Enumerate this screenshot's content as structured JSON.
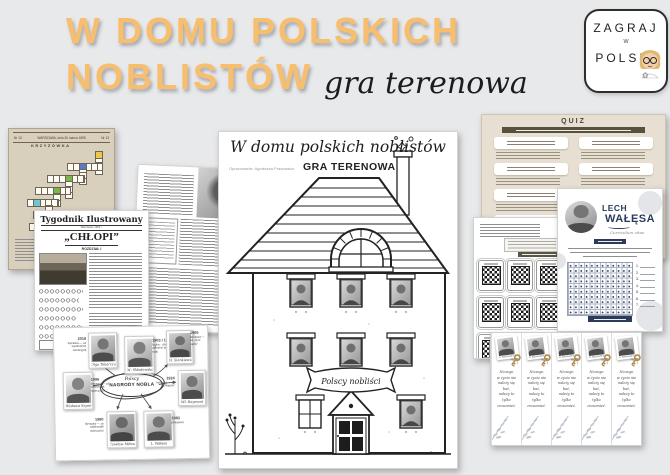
{
  "poster": {
    "title_line1": "W DOMU POLSKICH",
    "title_line2": "NOBLISTÓW",
    "subtitle": "gra terenowa"
  },
  "logo": {
    "word_top": "ZAGRAJ",
    "word_mid": "w",
    "word_bottom": "POLSKI",
    "flower": "✿"
  },
  "colors": {
    "accent_orange": "#F7BE6D",
    "navy": "#2C3B5A",
    "quiz_beige": "#E7DFD1",
    "quiz_bar": "#57503D",
    "crossword_tan": "#D9CFBD",
    "gold_key": "#B08A44"
  },
  "crossword_page": {
    "header_left": "Nr 13",
    "header_center": "WARSZAWA, dnia 26 marca 1895",
    "header_right": "Nr 13",
    "title": "KRZYŻÓWKA"
  },
  "newspaper_page": {
    "masthead": "Tygodnik Ilustrowany",
    "dateline": "Warszawa, 1904 r.",
    "title": "„CHŁOPI”",
    "chapter": "ROZDZIAŁ I"
  },
  "mindmap_page": {
    "center_top": "Polscy",
    "center_main": "NAGRODY NOBLA",
    "cards": [
      {
        "year": "2018",
        "info": "literacka — za wyobraźnię narracyjną",
        "name": "Olga Tokarczuk"
      },
      {
        "year": "1903 / 1911",
        "info": "fizyka · chemia — odkrycie polonu i radu",
        "name": "M. Skłodowska-Curie"
      },
      {
        "year": "1905",
        "info": "literacka — za „Quo vadis”",
        "name": "H. Sienkiewicz"
      },
      {
        "year": "1924",
        "info": "literacka — za „Chłopów”",
        "name": "Wł. Reymont"
      },
      {
        "year": "1996",
        "info": "literacka — za całokształt twórczości",
        "name": "Wisława Szymborska"
      },
      {
        "year": "1980",
        "info": "literacka — za całokształt twórczości",
        "name": "Czesław Miłosz"
      },
      {
        "year": "1983",
        "info": "pokojowa",
        "name": "L. Wałęsa"
      }
    ]
  },
  "house_page": {
    "title": "W domu polskich noblistów",
    "byline": "Opracowanie: Agnieszka Prasowska",
    "tagline": "GRA TERENOWA",
    "banner": "Polscy nobliści"
  },
  "quiz_page": {
    "title": "QUIZ"
  },
  "walesa_page": {
    "first_name": "LECH",
    "last_name": "WAŁĘSA",
    "subtitle": "Curriculum vitae",
    "answers": [
      "1.",
      "2.",
      "3.",
      "4.",
      "5.",
      "6.",
      "7."
    ]
  },
  "bookmarks_page": {
    "caption": "M. Skłodowska-Curie",
    "quote_lines": [
      "Niczego",
      "w życiu nie",
      "należy się",
      "bać,",
      "należy to",
      "tylko",
      "zrozumieć."
    ]
  }
}
